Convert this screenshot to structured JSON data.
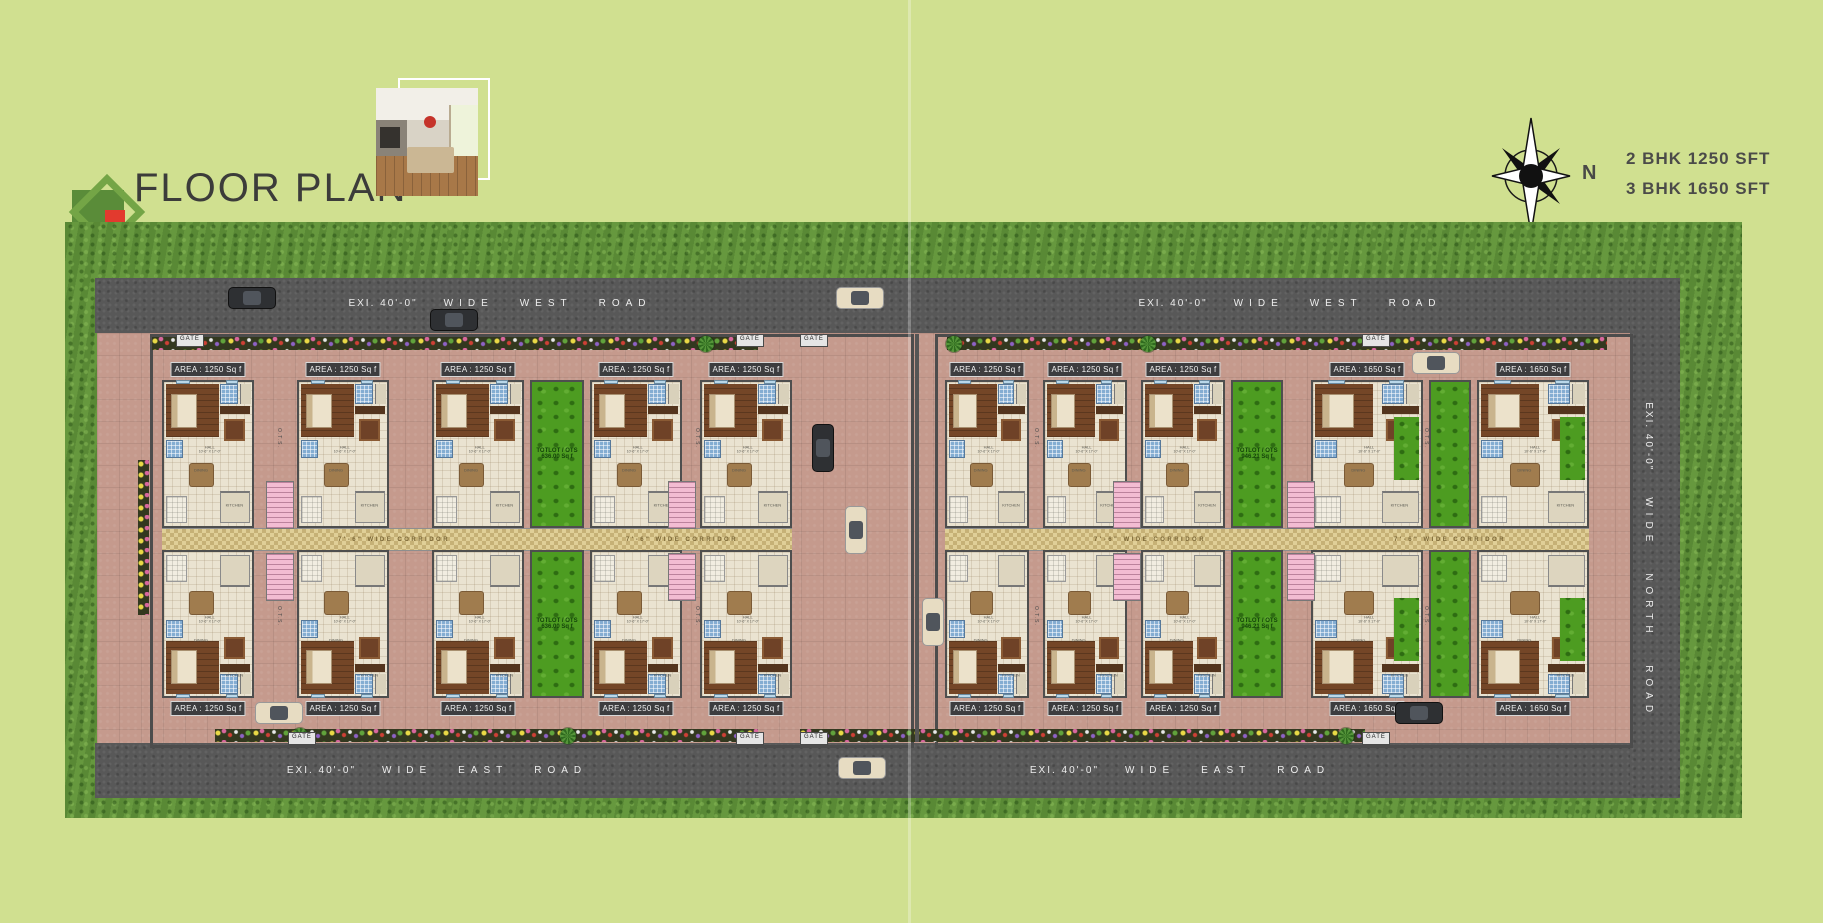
{
  "page": {
    "background": "#d0e090"
  },
  "header": {
    "title": "FLOOR PLAN"
  },
  "compass": {
    "north_label": "N"
  },
  "legend": {
    "lines": [
      "2 BHK 1250 SFT",
      "3 BHK 1650 SFT"
    ]
  },
  "colors": {
    "accent_green": "#74a546",
    "accent_red": "#e23a2e",
    "road": "#585858",
    "pavement": "#c59a8d",
    "grass": "#6a9b40",
    "totlot_green": "#4d9c21"
  },
  "roads": {
    "west_top": {
      "segments": [
        "EXI.  40'-0\"",
        "WIDE",
        "WEST",
        "ROAD"
      ],
      "instances": [
        {
          "cx": 500,
          "cy": 298
        },
        {
          "cx": 1290,
          "cy": 298
        }
      ]
    },
    "east_bottom": {
      "segments": [
        "EXI.  40'-0\"",
        "WIDE",
        "EAST",
        "ROAD"
      ],
      "instances": [
        {
          "cx": 437,
          "cy": 765
        },
        {
          "cx": 1180,
          "cy": 765
        }
      ]
    },
    "north_right": {
      "segments": [
        "EXI.  40'-0\"",
        "WIDE",
        "NORTH",
        "ROAD"
      ],
      "instances": [
        {
          "cx": 1649,
          "cy": 560
        }
      ]
    }
  },
  "site": {
    "gate_label": "GATE",
    "corridor_label": "7'-6\"  WIDE  CORRIDOR",
    "ots_label": "O.T.S.",
    "area_labels": {
      "bhk2": "AREA : 1250 Sq f",
      "bhk3": "AREA : 1650 Sq f"
    },
    "totlot_labels": {
      "left": [
        "TOTLOT / OTS",
        "636.00 Sq f"
      ],
      "right": [
        "TOTLOT / OTS",
        "946.21 Sq f"
      ]
    },
    "room_labels": {
      "hall": "HALL",
      "hall_dim": "10'-6\" X 17'-0\"",
      "kitchen": "KITCHEN",
      "kitchen_dim": "8'-0\" X 8'-0\"",
      "dining": "DINING",
      "dining_dim": "12'-0\" X 10'-0\"",
      "toilet": "TOILET",
      "bedroom": "BED ROOM",
      "sitout": "SIT OUT",
      "wash": "WASH",
      "dress": "DRESS"
    },
    "compounds": [
      {
        "id": "left",
        "wall": {
          "x": 150,
          "y": 334,
          "w": 758,
          "h": 408
        },
        "rows": {
          "top_y": 380,
          "bottom_y": 550,
          "h": 148,
          "badge_top_y": 362,
          "badge_bottom_y": 701
        },
        "corridor": {
          "x": 162,
          "y": 528,
          "w": 630,
          "h": 21
        },
        "corridor_label_cx": [
          394,
          682
        ],
        "units": [
          {
            "type": "bhk2",
            "x": 162,
            "w": 92
          },
          {
            "type": "bhk2",
            "x": 297,
            "w": 92
          },
          {
            "type": "bhk2",
            "x": 432,
            "w": 92
          },
          {
            "type": "totlot",
            "x": 530,
            "w": 54,
            "label": "left"
          },
          {
            "type": "bhk2",
            "x": 590,
            "w": 92
          },
          {
            "type": "bhk2",
            "x": 700,
            "w": 92
          }
        ]
      },
      {
        "id": "right",
        "wall": {
          "x": 935,
          "y": 334,
          "w": 692,
          "h": 408
        },
        "rows": {
          "top_y": 380,
          "bottom_y": 550,
          "h": 148,
          "badge_top_y": 362,
          "badge_bottom_y": 701
        },
        "corridor": {
          "x": 945,
          "y": 528,
          "w": 644,
          "h": 21
        },
        "corridor_label_cx": [
          1150,
          1450
        ],
        "units": [
          {
            "type": "bhk2",
            "x": 945,
            "w": 84
          },
          {
            "type": "bhk2",
            "x": 1043,
            "w": 84
          },
          {
            "type": "bhk2",
            "x": 1141,
            "w": 84
          },
          {
            "type": "totlot",
            "x": 1231,
            "w": 52,
            "label": "right"
          },
          {
            "type": "bhk3",
            "x": 1311,
            "w": 112
          },
          {
            "type": "totlot",
            "x": 1429,
            "w": 42,
            "label": null
          },
          {
            "type": "bhk3",
            "x": 1477,
            "w": 112
          }
        ]
      }
    ],
    "gates": [
      {
        "x": 176,
        "y": 334
      },
      {
        "x": 736,
        "y": 334
      },
      {
        "x": 800,
        "y": 334
      },
      {
        "x": 1362,
        "y": 334
      },
      {
        "x": 288,
        "y": 732
      },
      {
        "x": 736,
        "y": 732
      },
      {
        "x": 800,
        "y": 732
      },
      {
        "x": 1362,
        "y": 732
      }
    ],
    "ots_positions": [
      {
        "x": 276,
        "y": 428
      },
      {
        "x": 694,
        "y": 428
      },
      {
        "x": 276,
        "y": 606
      },
      {
        "x": 694,
        "y": 606
      },
      {
        "x": 1033,
        "y": 428
      },
      {
        "x": 1033,
        "y": 606
      },
      {
        "x": 1423,
        "y": 428
      },
      {
        "x": 1423,
        "y": 606
      }
    ],
    "stairs": [
      {
        "x": 266,
        "y": 481
      },
      {
        "x": 668,
        "y": 481
      },
      {
        "x": 266,
        "y": 553
      },
      {
        "x": 668,
        "y": 553
      },
      {
        "x": 1113,
        "y": 481
      },
      {
        "x": 1287,
        "y": 481
      },
      {
        "x": 1113,
        "y": 553
      },
      {
        "x": 1287,
        "y": 553
      }
    ],
    "flower_beds": [
      {
        "x": 152,
        "y": 337,
        "w": 606,
        "h": 13
      },
      {
        "x": 947,
        "y": 337,
        "w": 660,
        "h": 13
      },
      {
        "x": 215,
        "y": 729,
        "w": 543,
        "h": 13
      },
      {
        "x": 800,
        "y": 729,
        "w": 565,
        "h": 13
      },
      {
        "x": 138,
        "y": 460,
        "w": 11,
        "h": 155
      }
    ],
    "palms": [
      {
        "x": 698,
        "y": 336
      },
      {
        "x": 946,
        "y": 336
      },
      {
        "x": 1140,
        "y": 336
      },
      {
        "x": 292,
        "y": 728
      },
      {
        "x": 560,
        "y": 728
      },
      {
        "x": 1338,
        "y": 728
      }
    ]
  },
  "cars": [
    {
      "x": 228,
      "y": 287,
      "o": "h",
      "c": "dark"
    },
    {
      "x": 836,
      "y": 287,
      "o": "h",
      "c": "cream"
    },
    {
      "x": 430,
      "y": 309,
      "o": "h",
      "c": "dark"
    },
    {
      "x": 1412,
      "y": 352,
      "o": "h",
      "c": "cream"
    },
    {
      "x": 812,
      "y": 424,
      "o": "v",
      "c": "dark"
    },
    {
      "x": 845,
      "y": 506,
      "o": "v",
      "c": "cream"
    },
    {
      "x": 922,
      "y": 598,
      "o": "v",
      "c": "cream"
    },
    {
      "x": 255,
      "y": 702,
      "o": "h",
      "c": "cream"
    },
    {
      "x": 1395,
      "y": 702,
      "o": "h",
      "c": "dark"
    },
    {
      "x": 838,
      "y": 757,
      "o": "h",
      "c": "cream"
    }
  ]
}
